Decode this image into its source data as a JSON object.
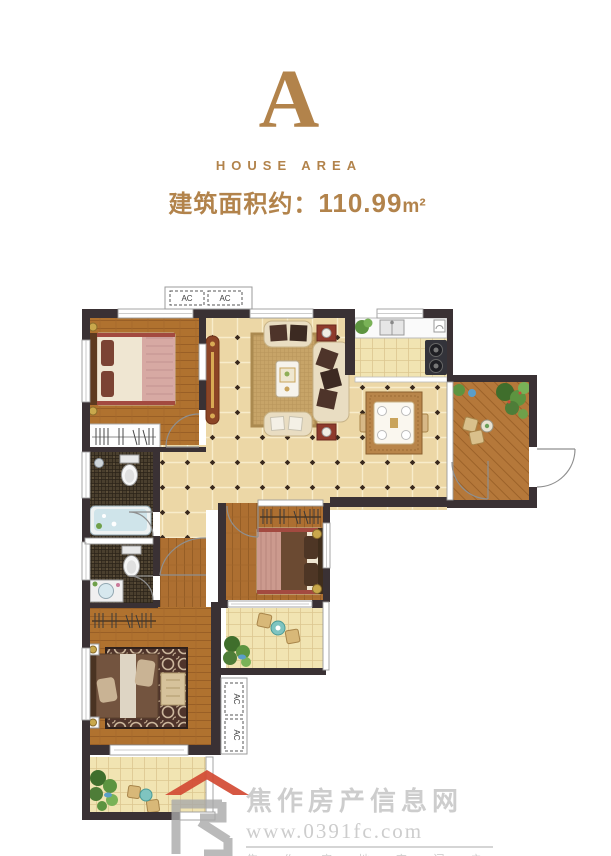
{
  "header": {
    "block_letter": "A",
    "block_subtitle": "HOUSE AREA",
    "area_label": "建筑面积约：",
    "area_value": "110.99",
    "area_unit": "m²"
  },
  "floorplan": {
    "ac_label": "AC"
  },
  "watermark": {
    "site_name": "焦作房产信息网",
    "site_url": "www.0391fc.com",
    "tagline": "焦 作 房 地 产 门 户"
  },
  "colors": {
    "accent_gold": "#b2834b",
    "wall_dark": "#3a3134",
    "wood_floor": "#b0722f",
    "tile_warm": "#ecd7a6",
    "tile_pale": "#f1e4b2",
    "bath_mosaic": "#4a3f2e",
    "logo_red": "#d24a33",
    "watermark_gray": "#cdcdcd"
  }
}
